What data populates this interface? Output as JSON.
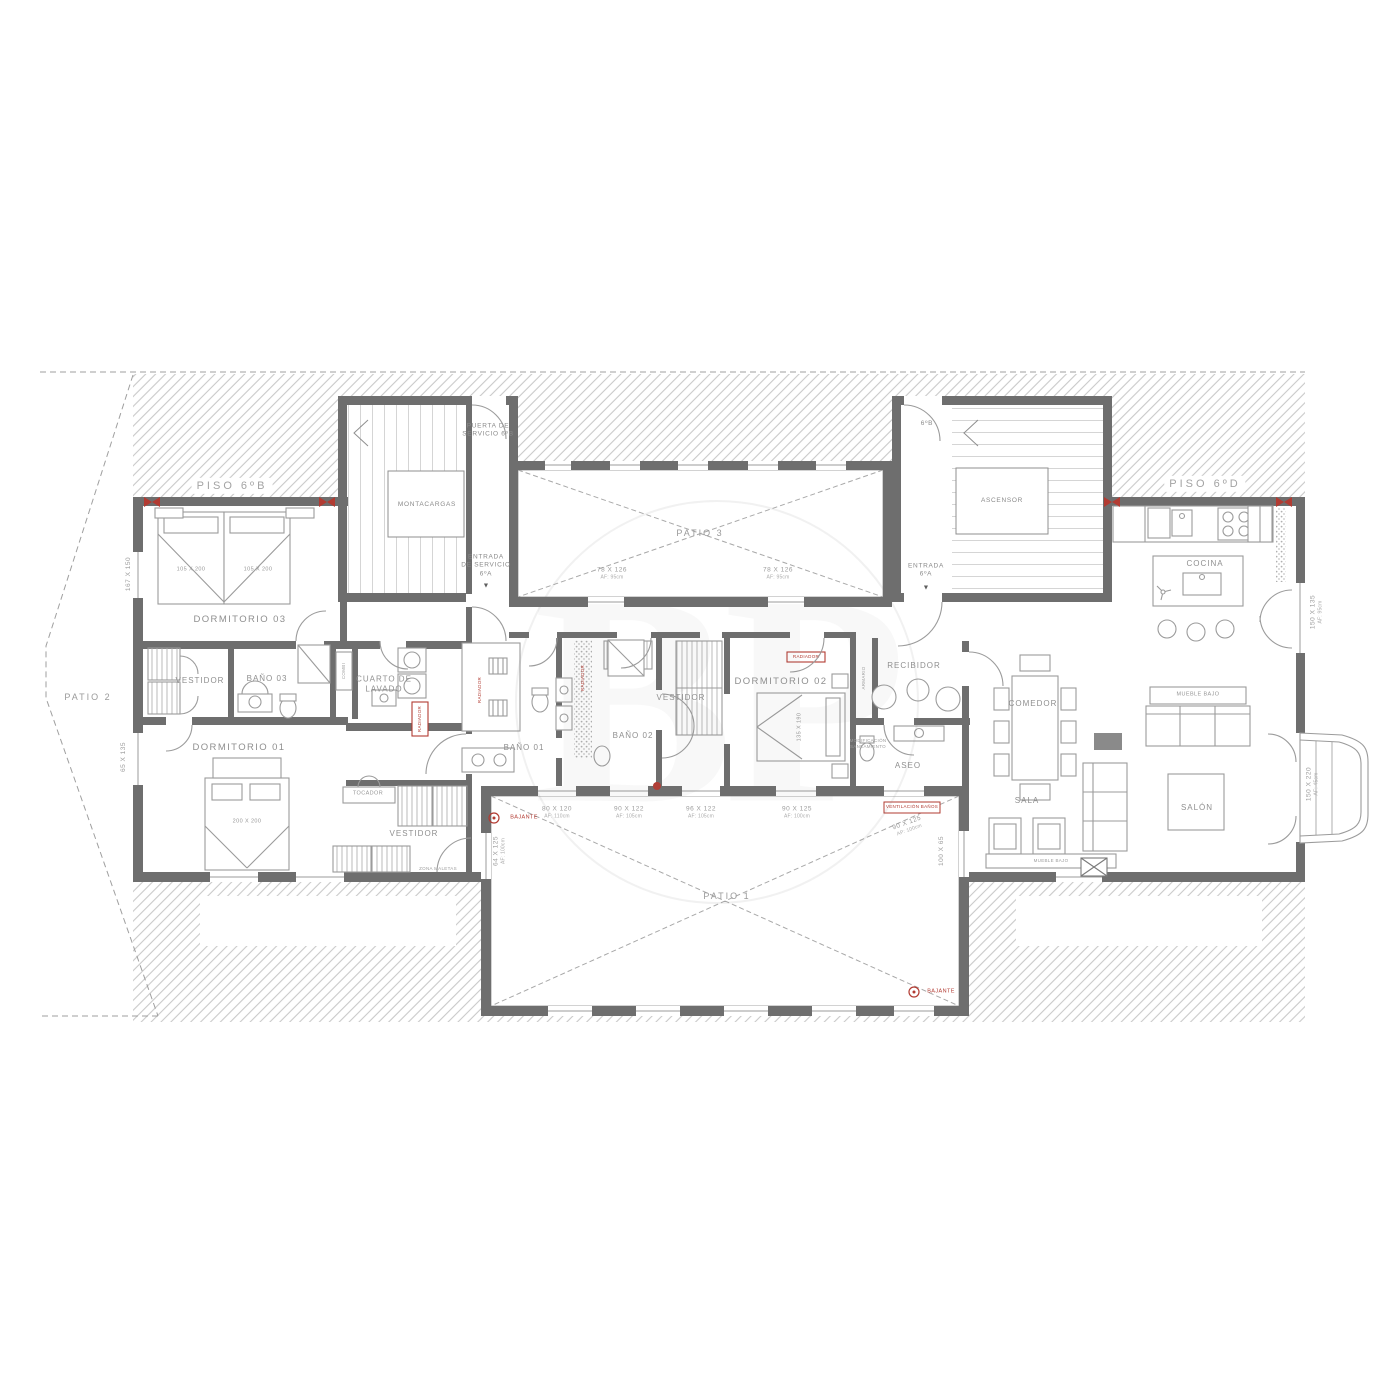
{
  "plan": {
    "watermark": "BP",
    "areas": {
      "piso_6b": "PISO 6ºB",
      "piso_6d": "PISO 6ºD",
      "patio_1": "PATIO 1",
      "patio_2": "PATIO 2",
      "patio_3": "PATIO 3"
    },
    "cores": {
      "montacargas": "MONTACARGAS",
      "ascensor": "ASCENSOR",
      "puerta_servicio": "PUERTA DE\nSERVICIO 6ºB",
      "entrada_servicio": "ENTRADA\nDE SERVICIO\n6ºA",
      "entrada": "ENTRADA\n6ºA",
      "ref_6b": "6ºB",
      "arrow": "▼"
    },
    "rooms": {
      "dormitorio_03": "DORMITORIO 03",
      "dormitorio_01": "DORMITORIO 01",
      "dormitorio_02": "DORMITORIO 02",
      "vestidor_a": "VESTIDOR",
      "vestidor_b": "VESTIDOR",
      "vestidor_c": "VESTIDOR",
      "bano_01": "BAÑO 01",
      "bano_02": "BAÑO 02",
      "bano_03": "BAÑO 03",
      "cuarto_lavado": "CUARTO DE\nLAVADO",
      "tocador": "TOCADOR",
      "recibidor": "RECIBIDOR",
      "aseo": "ASEO",
      "comedor": "COMEDOR",
      "sala": "SALA",
      "salon": "SALÓN",
      "cocina": "COCINA"
    },
    "furniture": {
      "mueble_bajo": "MUEBLE BAJO",
      "combi": "COMBI",
      "armario": "ARMARIO",
      "zona_maletas": "ZONA MALETAS",
      "bed_single_a": "105 X 200",
      "bed_single_b": "105 X 200",
      "bed_main": "200 X 200",
      "bed_guest": "135 X 190"
    },
    "windows": {
      "patio3_w1": {
        "size": "78 X 126",
        "sill": "AF: 95cm"
      },
      "patio3_w2": {
        "size": "78 X 126",
        "sill": "AF: 95cm"
      },
      "patio1_w1": {
        "size": "80 X 120",
        "sill": "AF: 110cm"
      },
      "patio1_w2": {
        "size": "90 X 122",
        "sill": "AF: 105cm"
      },
      "patio1_w3": {
        "size": "96 X 122",
        "sill": "AF: 105cm"
      },
      "patio1_w4": {
        "size": "90 X 125",
        "sill": "AF: 100cm"
      },
      "patio1_w5": {
        "size": "90 X 125",
        "sill": "AP: 100cm"
      },
      "patio1_w6": {
        "size": "64 X 125",
        "sill": "AF: 100cm"
      },
      "patio1_w7": {
        "size": "100 X 65"
      },
      "left_w1": {
        "size": "167 X 150"
      },
      "left_w2": {
        "size": "65 X 135"
      },
      "kitchen_w": {
        "size": "150 X 135",
        "sill": "AF: 95cm"
      },
      "bay_w": {
        "size": "150 X 220",
        "sill": "AF: 45cm"
      }
    },
    "red_notes": {
      "ventilacion": "VENTILACIÓN BAÑOS",
      "bajante_a": "BAJANTE",
      "bajante_b": "BAJANTE",
      "radiador": "RADIADOR"
    },
    "notes": {
      "modificacion": "MODIFICACIÓN\nSANEAMIENTO"
    },
    "colors": {
      "wall": "#6e6e6e",
      "hatch": "#c9c9c9",
      "furniture_line": "#9b9b9b",
      "text": "#8f8f8f",
      "red": "#b23b32"
    }
  }
}
